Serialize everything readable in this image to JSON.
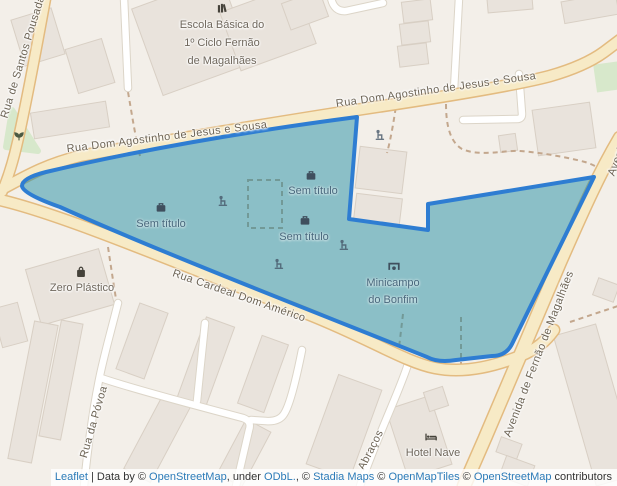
{
  "map": {
    "street_labels": [
      {
        "id": "santos-pousada",
        "text": "Rua de Santos Pousada"
      },
      {
        "id": "agostinho-1",
        "text": "Rua Dom Agostinho de Jesus e Sousa"
      },
      {
        "id": "agostinho-2",
        "text": "Rua Dom Agostinho de Jesus e Sousa"
      },
      {
        "id": "cardeal",
        "text": "Rua Cardeal Dom Américo"
      },
      {
        "id": "avenida-1",
        "text": "Avenida de Fernão de Magalhães"
      },
      {
        "id": "avenida-2",
        "text": "Avenida de Fernão de Magalhães"
      },
      {
        "id": "povoa",
        "text": "Rua da Póvoa"
      },
      {
        "id": "abracos",
        "text": "Abraços"
      }
    ],
    "poi_labels": {
      "school": {
        "lines": [
          "Escola Básica do",
          "1º Ciclo Fernão",
          "de Magalhães"
        ]
      },
      "zero_plastico": {
        "text": "Zero Plástico"
      },
      "hotel_nave": {
        "text": "Hotel Nave"
      }
    },
    "overlay_labels": {
      "sem_titulo_1": "Sem título",
      "sem_titulo_2": "Sem título",
      "sem_titulo_3": "Sem título",
      "minicampo": {
        "lines": [
          "Minicampo",
          "do Bonfim"
        ]
      }
    },
    "colors": {
      "map_background": "#f3efe9",
      "building_fill": "#e9e3dc",
      "road_main_fill": "#f7eac6",
      "road_main_casing": "#e3bb80",
      "road_white": "#ffffff",
      "path_dashed": "#c3a78d",
      "green_area": "#d7e8cb",
      "overlay_polygon_stroke": "#2e7dd2",
      "overlay_polygon_fill": "rgba(25,138,162,0.48)",
      "street_label": "#6d6455",
      "poi_label": "#6f675c",
      "overlay_label": "#48677c",
      "attribution_link": "#2c7bb8"
    },
    "attribution": {
      "segments": [
        {
          "text": "Leaflet",
          "link": true
        },
        {
          "text": " | Data by © ",
          "link": false
        },
        {
          "text": "OpenStreetMap",
          "link": true
        },
        {
          "text": ", under ",
          "link": false
        },
        {
          "text": "ODbL.",
          "link": true
        },
        {
          "text": ", © ",
          "link": false
        },
        {
          "text": "Stadia Maps",
          "link": true
        },
        {
          "text": " © ",
          "link": false
        },
        {
          "text": "OpenMapTiles",
          "link": true
        },
        {
          "text": " © ",
          "link": false
        },
        {
          "text": "OpenStreetMap",
          "link": true
        },
        {
          "text": " contributors",
          "link": false
        }
      ]
    }
  }
}
